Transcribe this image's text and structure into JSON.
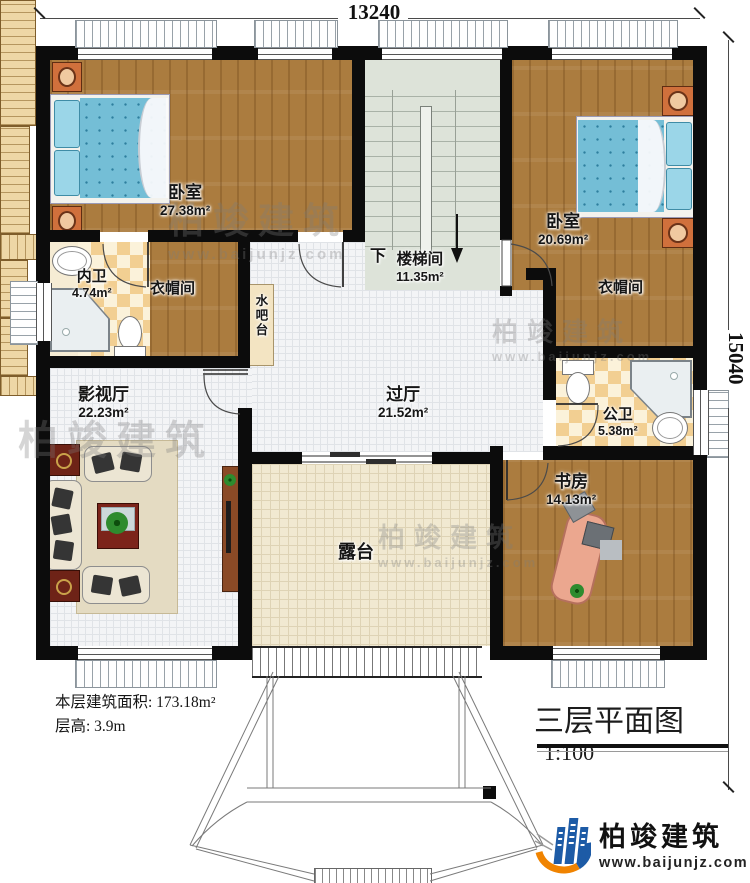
{
  "dimensions": {
    "width_mm": "13240",
    "height_mm": "15040"
  },
  "rooms": {
    "bedroom_left": {
      "name": "卧室",
      "area": "27.38m²"
    },
    "ensuite_bath": {
      "name": "内卫",
      "area": "4.74m²"
    },
    "cloakroom_left": {
      "name": "衣帽间"
    },
    "water_bar": {
      "name": "水吧台"
    },
    "stairwell": {
      "name": "楼梯间",
      "area": "11.35m²",
      "down_label": "下"
    },
    "bedroom_right": {
      "name": "卧室",
      "area": "20.69m²"
    },
    "cloakroom_right": {
      "name": "衣帽间"
    },
    "hall": {
      "name": "过厅",
      "area": "21.52m²"
    },
    "public_bath": {
      "name": "公卫",
      "area": "5.38m²"
    },
    "media_room": {
      "name": "影视厅",
      "area": "22.23m²"
    },
    "study": {
      "name": "书房",
      "area": "14.13m²"
    },
    "terrace": {
      "name": "露台"
    }
  },
  "notes": {
    "floor_area": "本层建筑面积: 173.18m²",
    "floor_height": "层高: 3.9m"
  },
  "title_block": {
    "title": "三层平面图",
    "scale": "1:100"
  },
  "branding": {
    "company": "柏竣建筑",
    "website": "www.baijunjz.com"
  },
  "watermark": {
    "company": "柏竣建筑",
    "website": "www.baijunjz.com"
  },
  "colors": {
    "wall": "#0c0c0c",
    "wood": "#ab7c3f",
    "tile": "#f3f4f6",
    "terrace": "#f1e9d1",
    "stair": "#dde3d9",
    "checker": "#f2cf92",
    "mattress": "#74bed6",
    "logo_blue": "#1d5ba6",
    "logo_orange": "#f08300"
  }
}
